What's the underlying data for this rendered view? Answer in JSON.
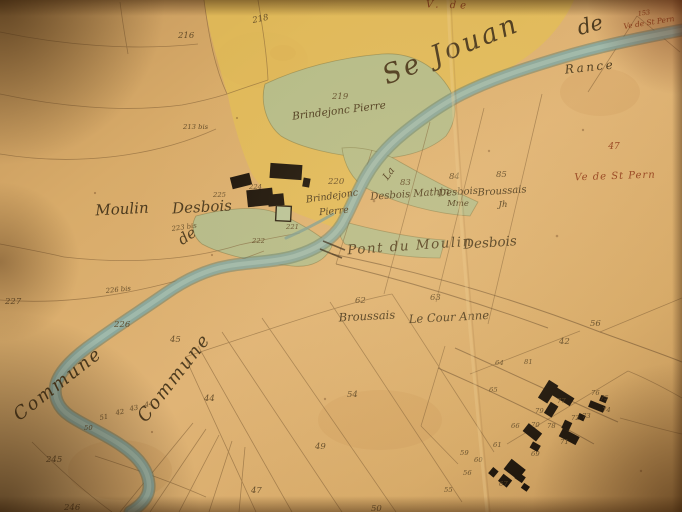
{
  "palette": {
    "paper": "#d8ab69",
    "yellow_wash": "#e2bd55",
    "green_wash": "#b2bd8d",
    "river_blue": "#8aa89d",
    "river_dark": "#5d7a6c",
    "ink_line": "#7b5a33",
    "ink_script": "#4c3a1e",
    "ink_red": "#96431f",
    "building_black": "#191109"
  },
  "labels": {
    "territory": {
      "se_jouan": "Se Jouan",
      "de_large": "de",
      "commune_left": "Commune",
      "commune_right": "Commune",
      "de_flourish": "de",
      "la": "La"
    },
    "river_name": "Rance",
    "red": {
      "top_partial": "V. de",
      "num_153": "153",
      "pern_small": "Ve de St Pern",
      "num_47": "47",
      "pern_large": "Ve de St Pern"
    },
    "places": {
      "moulin": "Moulin",
      "desbois": "Desbois",
      "pont_du_moulin": "Pont du Moulin",
      "pont_desbois": "Desbois"
    },
    "parcels_named": {
      "p219": "219",
      "p219_owner": "Brindejonc  Pierre",
      "p220": "220",
      "p220_owner": "Brindejonc",
      "p220_owner2": "Pierre",
      "p83": "83",
      "p83_owner": "Desbois Mathin",
      "p84": "84",
      "p84_owner": "Desbois",
      "p84_owner2": "Mme",
      "p85": "85",
      "p85_owner": "Broussais",
      "p85_owner2": "Jh",
      "p62": "62",
      "p62_owner": "Broussais",
      "p63": "63",
      "p63_owner": "Le Cour Anne"
    },
    "parcel_numbers": [
      {
        "t": "216",
        "x": 178,
        "y": 38
      },
      {
        "t": "218",
        "x": 253,
        "y": 23,
        "r": -12
      },
      {
        "t": "213 bis",
        "x": 183,
        "y": 129,
        "s": "tiny"
      },
      {
        "t": "227",
        "x": 5,
        "y": 304
      },
      {
        "t": "226 bis",
        "x": 106,
        "y": 293,
        "s": "tiny",
        "r": -6
      },
      {
        "t": "226",
        "x": 114,
        "y": 327
      },
      {
        "t": "245",
        "x": 46,
        "y": 462
      },
      {
        "t": "246",
        "x": 64,
        "y": 510
      },
      {
        "t": "50",
        "x": 84,
        "y": 430,
        "s": "tiny"
      },
      {
        "t": "51",
        "x": 100,
        "y": 420,
        "s": "tiny",
        "r": -10
      },
      {
        "t": "42",
        "x": 116,
        "y": 415,
        "s": "tiny",
        "r": -10
      },
      {
        "t": "43",
        "x": 130,
        "y": 411,
        "s": "tiny",
        "r": -10
      },
      {
        "t": "44",
        "x": 145,
        "y": 407,
        "s": "tiny",
        "r": -10
      },
      {
        "t": "45",
        "x": 170,
        "y": 342
      },
      {
        "t": "44",
        "x": 204,
        "y": 401
      },
      {
        "t": "54",
        "x": 347,
        "y": 397
      },
      {
        "t": "49",
        "x": 315,
        "y": 449
      },
      {
        "t": "47",
        "x": 251,
        "y": 493
      },
      {
        "t": "50",
        "x": 371,
        "y": 511
      },
      {
        "t": "56",
        "x": 590,
        "y": 326
      },
      {
        "t": "42",
        "x": 559,
        "y": 344
      },
      {
        "t": "64",
        "x": 495,
        "y": 365,
        "s": "tiny"
      },
      {
        "t": "81",
        "x": 524,
        "y": 364,
        "s": "tiny"
      },
      {
        "t": "65",
        "x": 489,
        "y": 392,
        "s": "tiny"
      },
      {
        "t": "66",
        "x": 511,
        "y": 428,
        "s": "tiny"
      },
      {
        "t": "70",
        "x": 531,
        "y": 427,
        "s": "tiny"
      },
      {
        "t": "77",
        "x": 557,
        "y": 403,
        "s": "tiny"
      },
      {
        "t": "79",
        "x": 535,
        "y": 413,
        "s": "tiny"
      },
      {
        "t": "78",
        "x": 547,
        "y": 428,
        "s": "tiny"
      },
      {
        "t": "76",
        "x": 591,
        "y": 395,
        "s": "tiny"
      },
      {
        "t": "75",
        "x": 600,
        "y": 400,
        "s": "tiny"
      },
      {
        "t": "74",
        "x": 602,
        "y": 412,
        "s": "tiny"
      },
      {
        "t": "73",
        "x": 582,
        "y": 418,
        "s": "tiny"
      },
      {
        "t": "72",
        "x": 571,
        "y": 420,
        "s": "tiny"
      },
      {
        "t": "71",
        "x": 560,
        "y": 444,
        "s": "tiny"
      },
      {
        "t": "69",
        "x": 531,
        "y": 456,
        "s": "tiny"
      },
      {
        "t": "61",
        "x": 493,
        "y": 447,
        "s": "tiny"
      },
      {
        "t": "60",
        "x": 474,
        "y": 462,
        "s": "tiny"
      },
      {
        "t": "59",
        "x": 460,
        "y": 455,
        "s": "tiny"
      },
      {
        "t": "56",
        "x": 463,
        "y": 475,
        "s": "tiny"
      },
      {
        "t": "55",
        "x": 444,
        "y": 492,
        "s": "tiny"
      },
      {
        "t": "67",
        "x": 499,
        "y": 486,
        "s": "tiny"
      },
      {
        "t": "221",
        "x": 286,
        "y": 229,
        "s": "tiny"
      },
      {
        "t": "222",
        "x": 252,
        "y": 243,
        "s": "tiny"
      },
      {
        "t": "224",
        "x": 249,
        "y": 189,
        "s": "tiny"
      },
      {
        "t": "225",
        "x": 213,
        "y": 197,
        "s": "tiny"
      },
      {
        "t": "223 bis",
        "x": 172,
        "y": 231,
        "s": "tiny",
        "r": -8
      }
    ]
  }
}
